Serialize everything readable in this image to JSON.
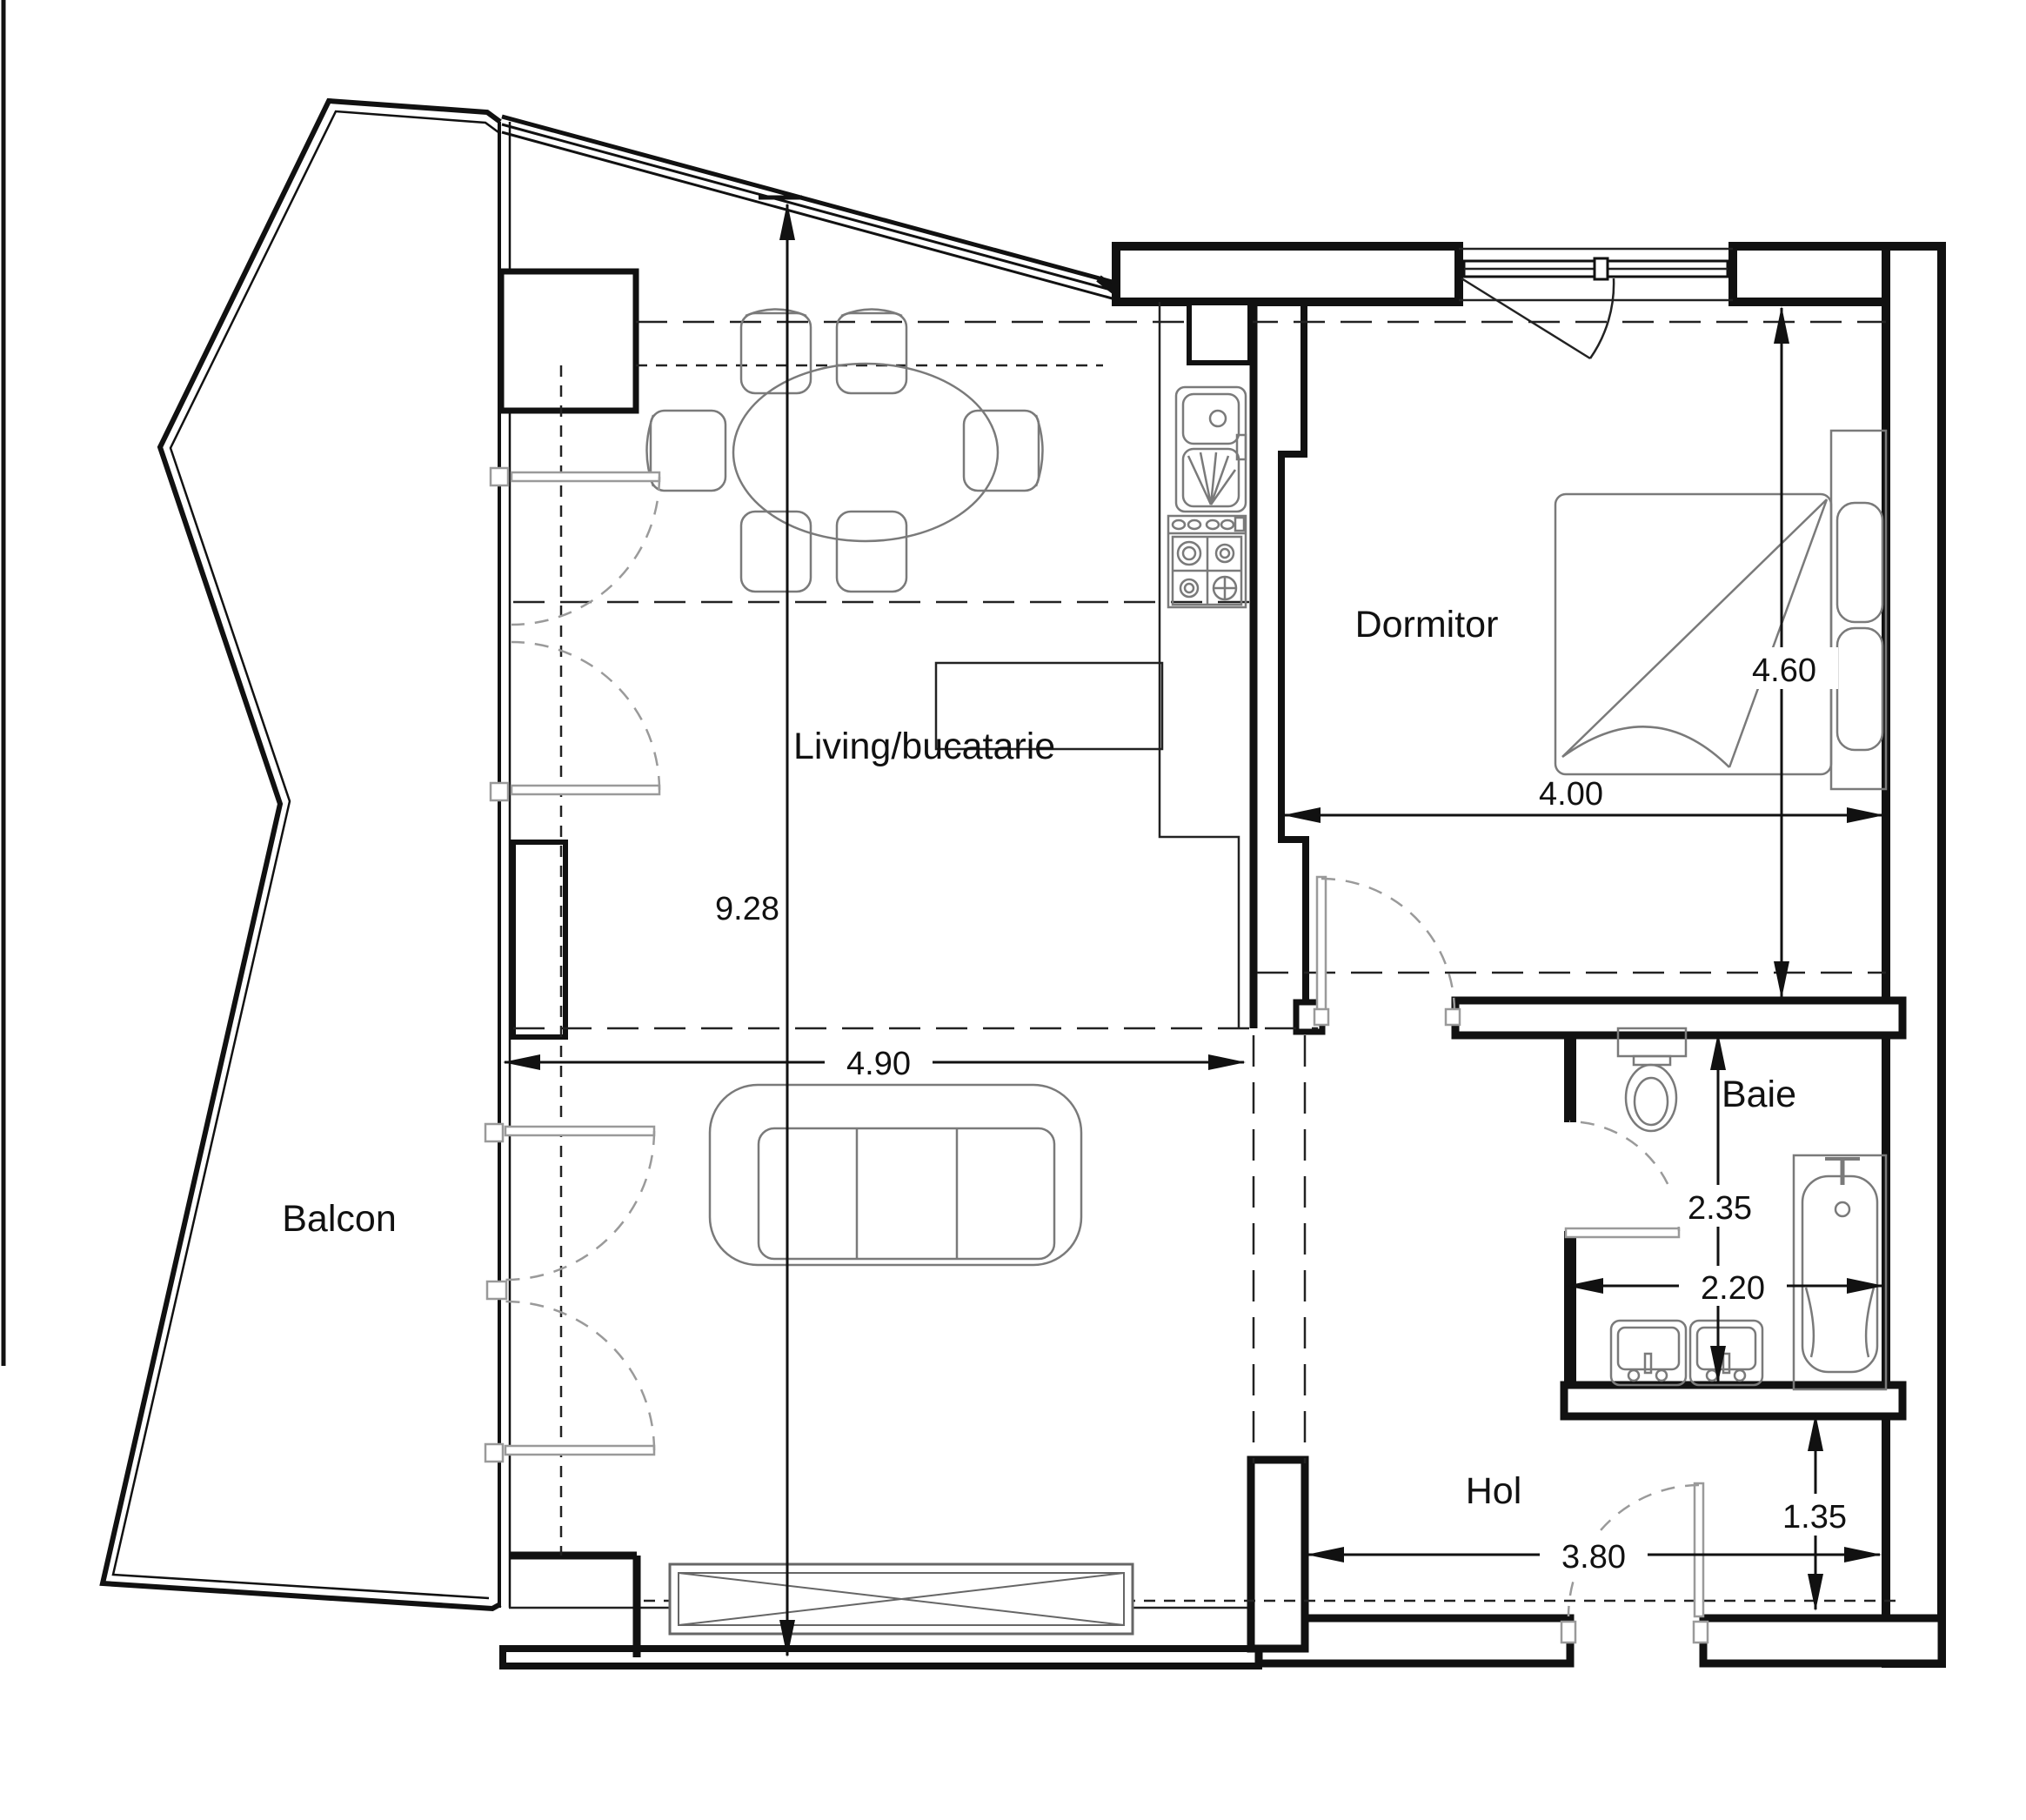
{
  "drawing_type": "apartment floor plan",
  "colors": {
    "background": "#ffffff",
    "walls": "#111111",
    "furniture_lines": "#7a7a7a",
    "door_symbols": "#9a9a9a"
  },
  "rooms": {
    "living": {
      "label": "Living/bucatarie"
    },
    "bedroom": {
      "label": "Dormitor"
    },
    "bathroom": {
      "label": "Baie"
    },
    "hall": {
      "label": "Hol"
    },
    "balcony": {
      "label": "Balcon"
    }
  },
  "dimensions": {
    "plan_height_m": {
      "value": "9.28"
    },
    "living_width_m": {
      "value": "4.90"
    },
    "bedroom_height_m": {
      "value": "4.60"
    },
    "bedroom_width_m": {
      "value": "4.00"
    },
    "bath_height_m": {
      "value": "2.35"
    },
    "bath_width_m": {
      "value": "2.20"
    },
    "hall_depth_m": {
      "value": "1.35"
    },
    "hall_width_m": {
      "value": "3.80"
    }
  }
}
